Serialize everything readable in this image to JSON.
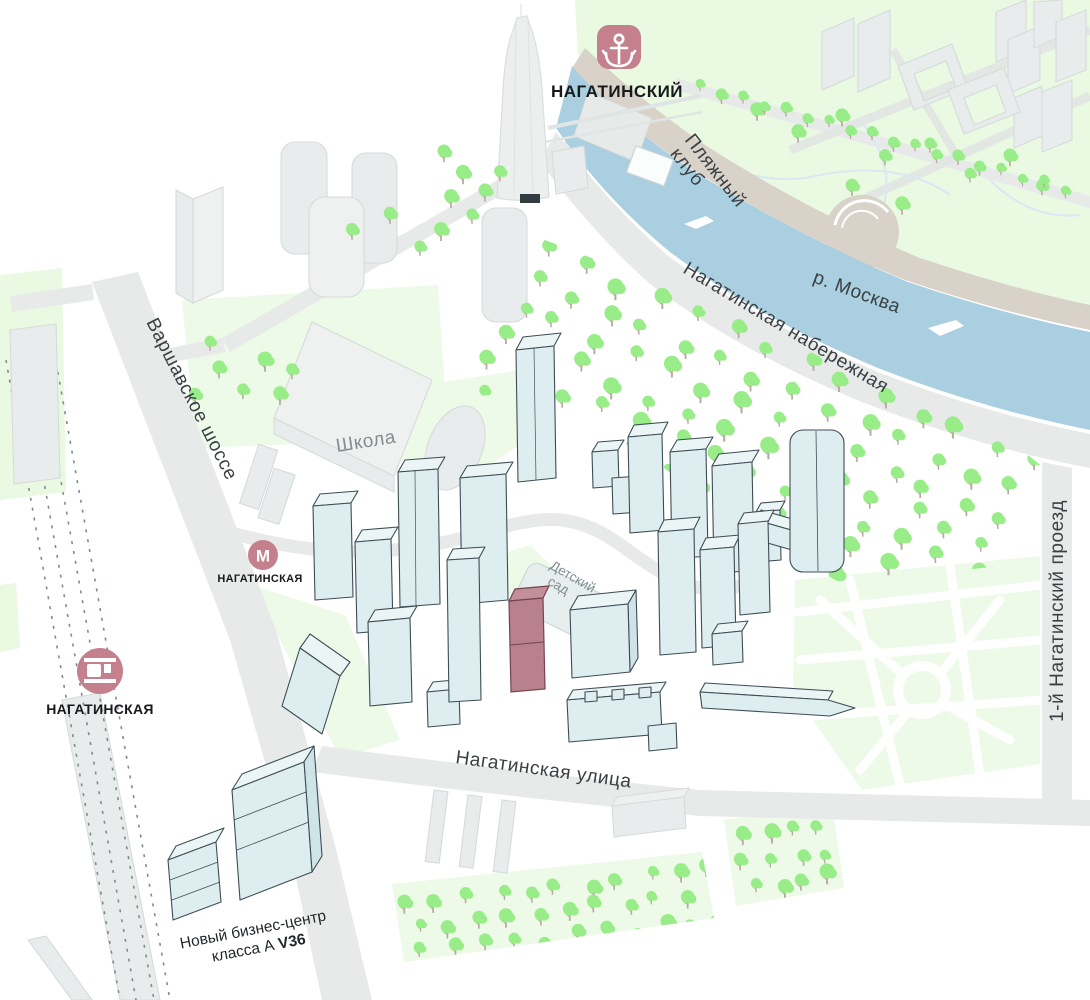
{
  "poi": {
    "project": {
      "name": "НАГАТИНСКИЙ"
    },
    "metro": {
      "name": "НАГАТИНСКАЯ",
      "icon_letter": "М"
    },
    "railway": {
      "name": "НАГАТИНСКАЯ"
    },
    "school": {
      "name": "Школа"
    },
    "kindergarten": {
      "line1": "Детский",
      "line2": "сад"
    },
    "beach_club": {
      "line1": "Пляжный",
      "line2": "клуб"
    },
    "business_center": {
      "line1": "Новый бизнес-центр",
      "line2": "класса А ",
      "line2_bold": "V36"
    }
  },
  "streets": {
    "varshavskoe": "Варшавское шоссе",
    "naberezhnaya": "Нагатинская набережная",
    "ulitsa": "Нагатинская улица",
    "proezd": "1-й Нагатинский проезд"
  },
  "water": {
    "river": "р. Москва"
  },
  "icons": {
    "project_marker": "anchor-icon",
    "metro_marker": "metro-m-icon",
    "railway_marker": "train-icon"
  },
  "colors": {
    "accent_rose": "#c4808c",
    "highlighted_building": "#b9818e",
    "new_buildings": "#deeef0",
    "old_buildings": "#e9ecec",
    "water": "#aacfe0",
    "river_bank": "#d9d2c8",
    "trees": "#99ed88",
    "park": "#e9f9e2",
    "roads": "#e7eae9"
  }
}
